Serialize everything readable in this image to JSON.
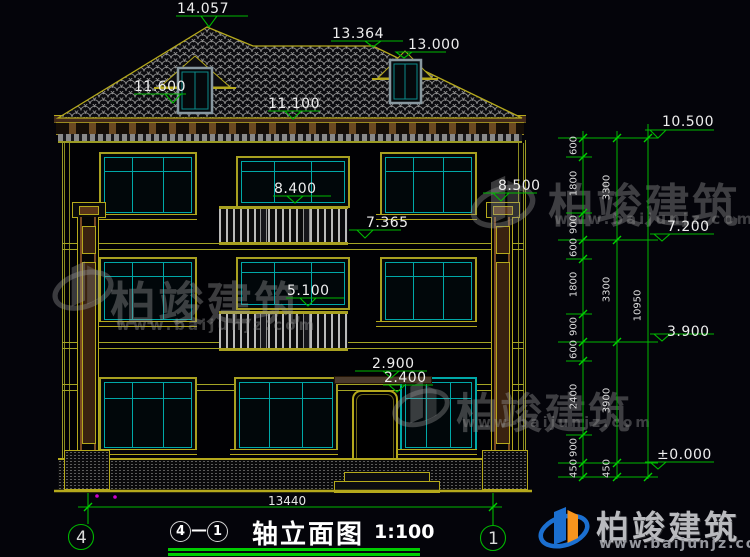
{
  "title": {
    "axis_from": "4",
    "dash": "—",
    "axis_to": "1",
    "text": "轴立面图",
    "scale": "1:100"
  },
  "axis_bubbles": {
    "left": "4",
    "right": "1"
  },
  "markers": {
    "ridge": "14.057",
    "ridge2": "13.364",
    "dormer": "13.000",
    "dormer_sill": "11.600",
    "eave": "11.100",
    "f3_door_top": "8.400",
    "pilaster_top": "8.500",
    "f3_rail": "7.365",
    "f2_door_top": "5.100",
    "canopy": "2.900",
    "door_top": "2.400",
    "right_eave": "10.500",
    "right_f3": "7.200",
    "right_f2": "3.900",
    "right_ground": "±0.000"
  },
  "chains": {
    "inner": [
      "600",
      "1800",
      "900",
      "600",
      "1800",
      "900",
      "600",
      "2400",
      "900",
      "450"
    ],
    "outer": [
      "3300",
      "3300",
      "3900",
      "450"
    ],
    "overall": "10950"
  },
  "bottom_dim": {
    "width": "13440"
  },
  "watermark": {
    "brand": "柏竣建筑",
    "url": "www.baijunjz.com"
  },
  "logo": {
    "brand": "柏竣建筑",
    "url": "www.baijunjz.com"
  },
  "colors": {
    "cad_green": "#00b800",
    "cad_yellow": "#b5a91c",
    "cad_cyan": "#00a8a8",
    "logo_blue": "#1b6fd0",
    "logo_orange": "#f7941d"
  }
}
